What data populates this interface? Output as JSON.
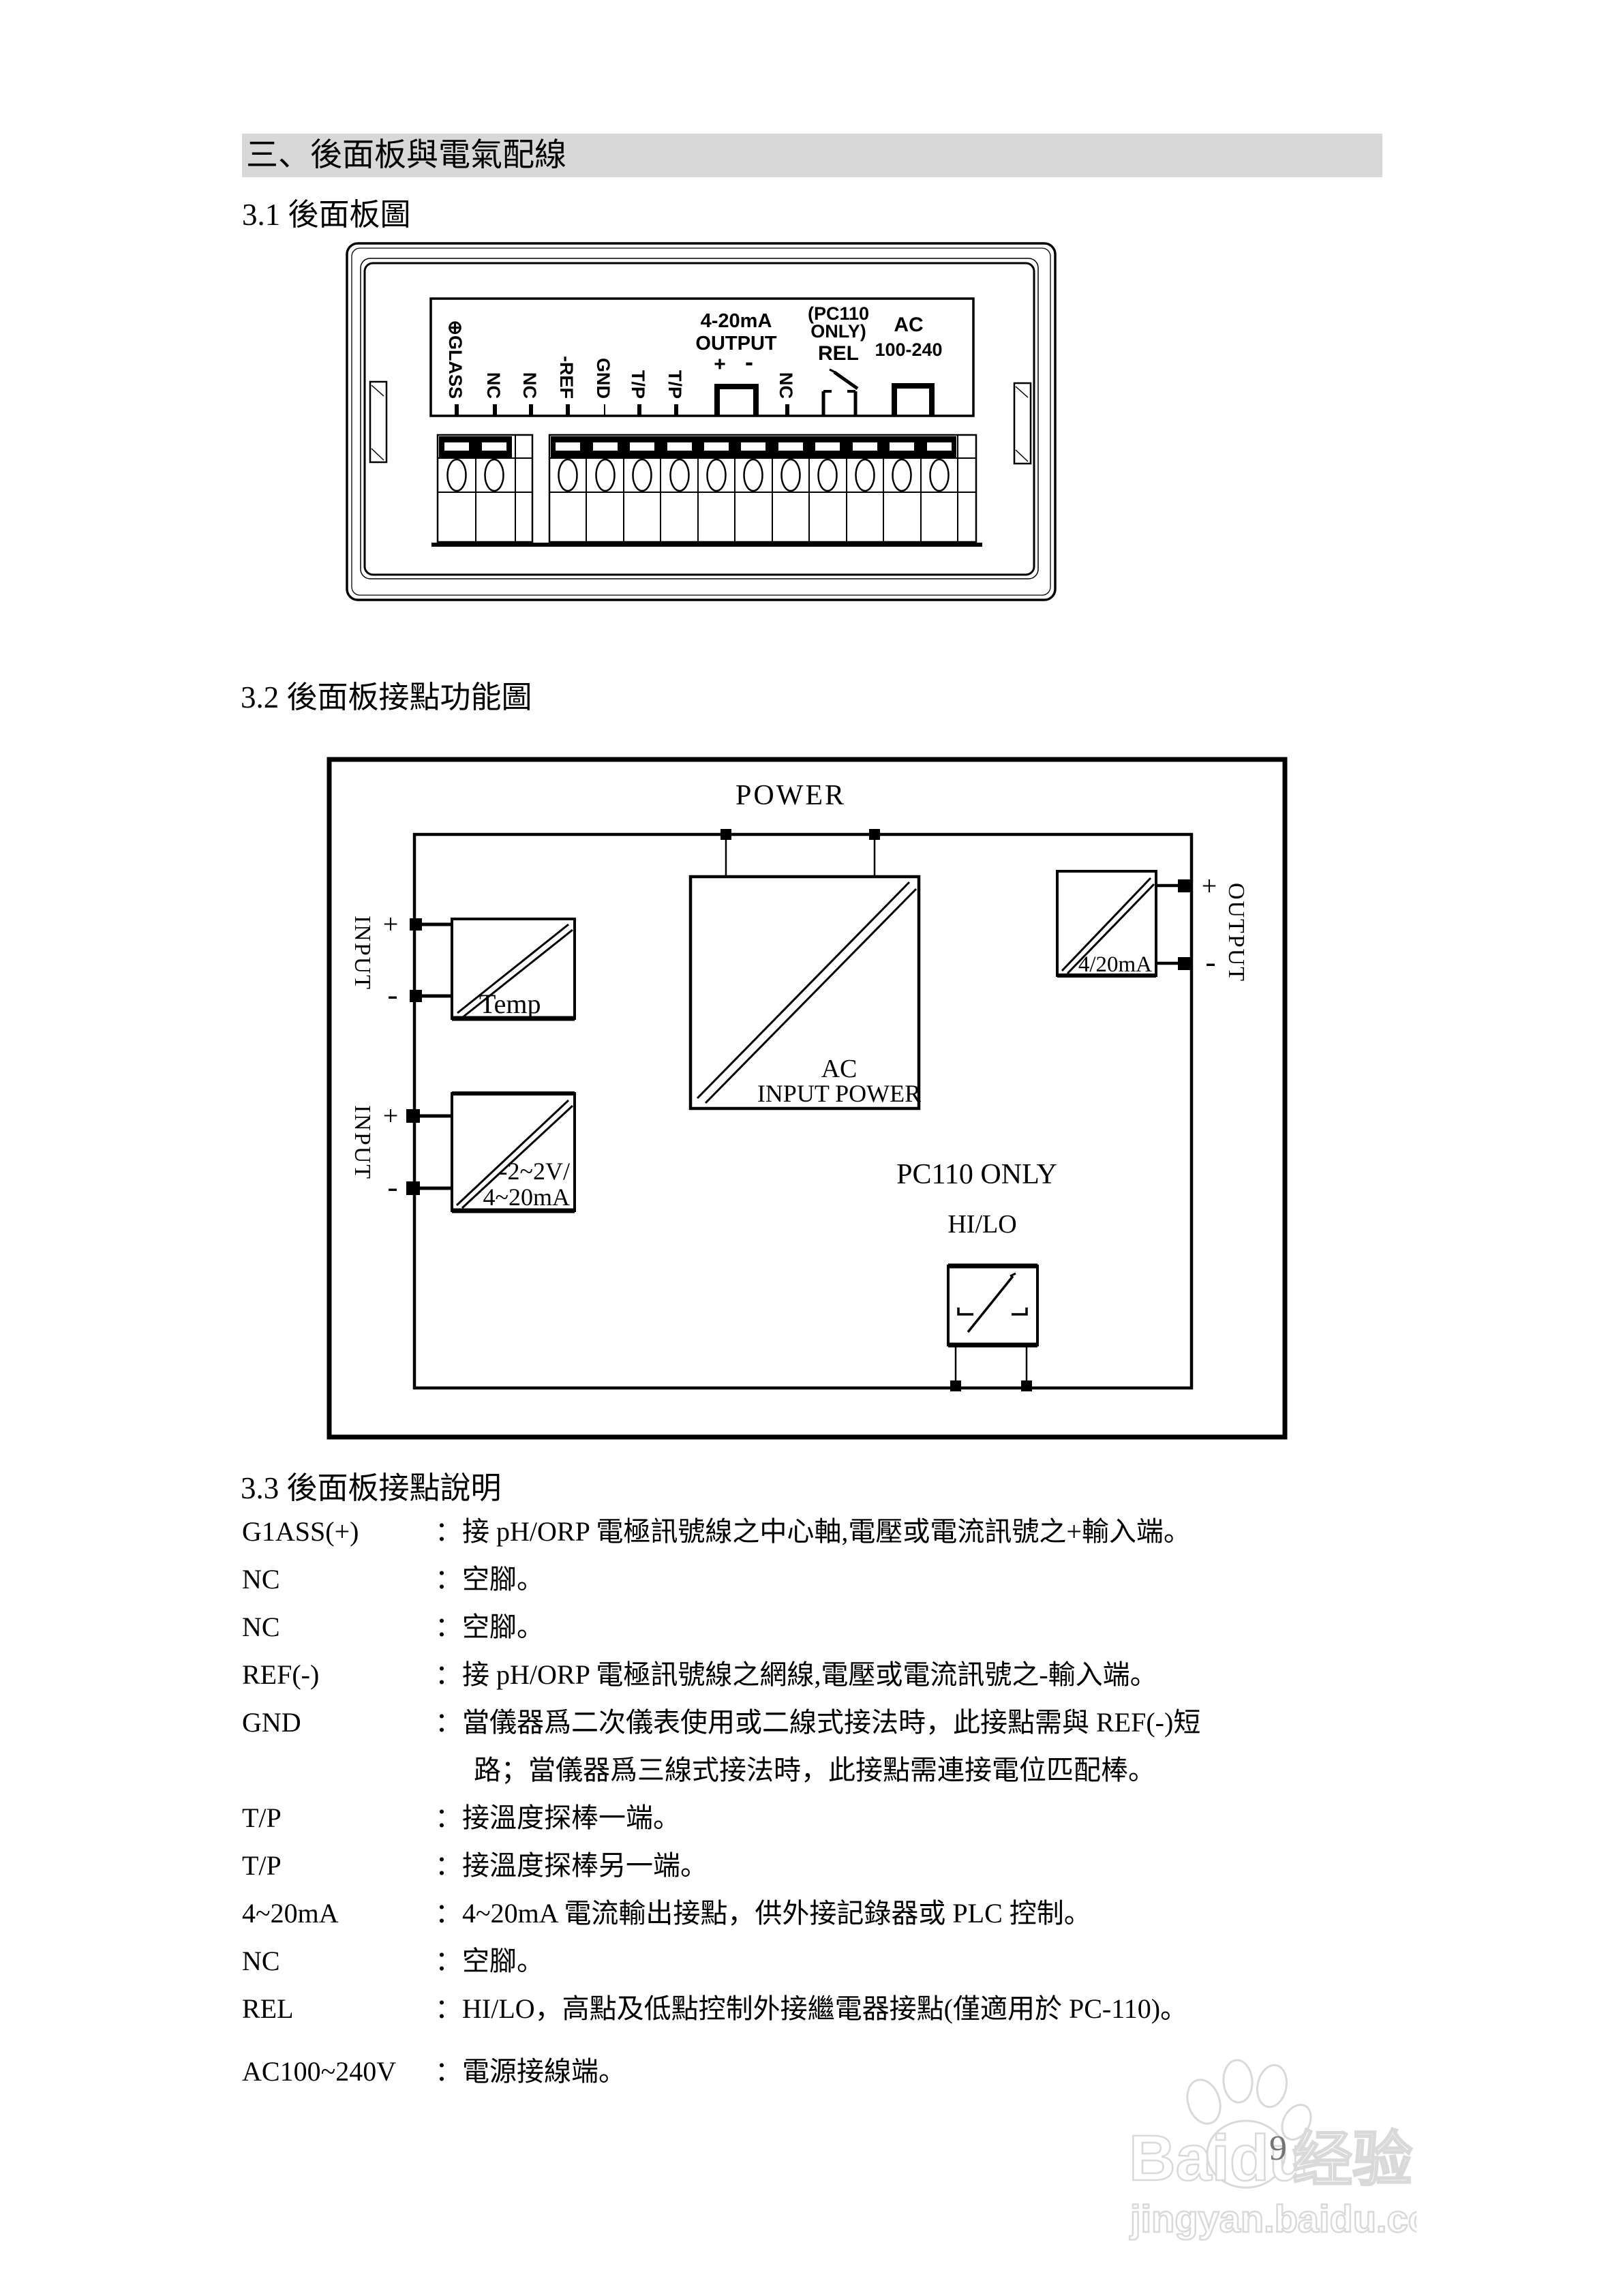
{
  "page": {
    "section_header": "三、後面板與電氣配線",
    "s31_title": "3.1 後面板圖",
    "s32_title": "3.2 後面板接點功能圖",
    "s33_title": "3.3 後面板接點說明",
    "page_number": "9"
  },
  "colors": {
    "header_bar": "#d8d8d8",
    "watermark_gray": "#d9d9d9"
  },
  "panel_diagram": {
    "vertical_labels": [
      "⊕GLASS",
      "NC",
      "NC",
      "-REF",
      "GND",
      "T/P",
      "T/P"
    ],
    "nc_right": "NC",
    "out_l1": "4-20mA",
    "out_l2": "OUTPUT",
    "plus": "+",
    "minus": "-",
    "rel_l1": "(PC110",
    "rel_l2": "ONLY)",
    "rel_l3": "REL",
    "ac_l1": "AC",
    "ac_l2": "100-240"
  },
  "block_diagram": {
    "power": "POWER",
    "input": "INPUT",
    "output": "OUTPUT",
    "plus": "+",
    "minus": "-",
    "temp_box": "Temp",
    "signal_l1": "-2~2V/",
    "signal_l2": "4~20mA",
    "ac_l1": "AC",
    "ac_l2": "INPUT POWER",
    "out_box": "4/20mA",
    "pc110_only": "PC110 ONLY",
    "hilo": "HI/LO"
  },
  "terminals": [
    {
      "term": "G1ASS(+)",
      "desc": "：接 pH/ORP 電極訊號線之中心軸,電壓或電流訊號之+輸入端。"
    },
    {
      "term": "NC",
      "desc": "：空腳。"
    },
    {
      "term": "NC",
      "desc": "：空腳。"
    },
    {
      "term": "REF(-)",
      "desc": "：接 pH/ORP 電極訊號線之網線,電壓或電流訊號之-輸入端。"
    },
    {
      "term": "GND",
      "desc": "：當儀器爲二次儀表使用或二線式接法時，此接點需與 REF(-)短",
      "desc2": "路；當儀器爲三線式接法時，此接點需連接電位匹配棒。"
    },
    {
      "term": "T/P",
      "desc": "：接溫度探棒一端。"
    },
    {
      "term": "T/P",
      "desc": "：接溫度探棒另一端。"
    },
    {
      "term": "4~20mA",
      "desc": "：4~20mA 電流輸出接點，供外接記錄器或 PLC 控制。"
    },
    {
      "term": "NC",
      "desc": "：空腳。"
    },
    {
      "term": "REL",
      "desc": "：HI/LO，高點及低點控制外接繼電器接點(僅適用於 PC-110)。"
    },
    {
      "term": "AC100~240V",
      "desc": "：電源接線端。"
    }
  ],
  "watermark": {
    "brand": "Baidu",
    "brand_cn": "经验",
    "url": "jingyan.baidu.com"
  }
}
